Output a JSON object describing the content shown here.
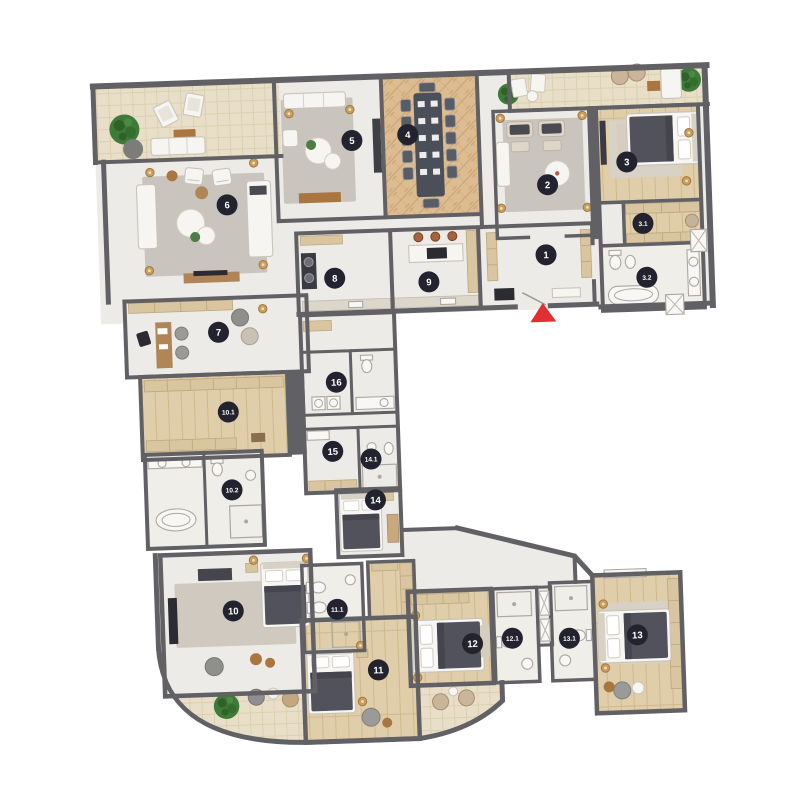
{
  "page": {
    "background": "#FFFFFF",
    "content": "apartment floor plan, C-shaped, top-down furnished view"
  },
  "plan": {
    "rotation_deg": -2,
    "entrance": {
      "marker": "red-arrow",
      "color": "#E03131"
    },
    "colors": {
      "wall": "#616165",
      "stone_floor": "#EDEBE7",
      "bath_floor": "#F0EEE9",
      "terrace_floor": "#E9DFC8",
      "wood_floor": "#E0CDA9",
      "herringbone_floor": "#DCBC90",
      "rug": "#C9C5BE",
      "badge_bg": "#23232F",
      "badge_text": "#FFFFFF",
      "tree_green": "#3E7B39",
      "gold_lamp": "#C99F5F",
      "copper_pendant": "#A5643E",
      "wood_furniture": "#AF8557",
      "wardrobe_tan": "#D9C6A0",
      "dark_furniture": "#3A3A42"
    },
    "rooms": [
      {
        "label": "1",
        "kind": "entrance-hall"
      },
      {
        "label": "2",
        "kind": "family-room"
      },
      {
        "label": "3",
        "kind": "bedroom"
      },
      {
        "label": "3.1",
        "kind": "walk-in-closet"
      },
      {
        "label": "3.2",
        "kind": "bathroom"
      },
      {
        "label": "4",
        "kind": "dining-room"
      },
      {
        "label": "5",
        "kind": "living-room"
      },
      {
        "label": "6",
        "kind": "living-room"
      },
      {
        "label": "7",
        "kind": "study"
      },
      {
        "label": "8",
        "kind": "laundry"
      },
      {
        "label": "9",
        "kind": "kitchen"
      },
      {
        "label": "10",
        "kind": "master-bedroom"
      },
      {
        "label": "10.1",
        "kind": "walk-in-closet"
      },
      {
        "label": "10.2",
        "kind": "bathroom"
      },
      {
        "label": "11",
        "kind": "bedroom"
      },
      {
        "label": "11.1",
        "kind": "bathroom"
      },
      {
        "label": "12",
        "kind": "bedroom"
      },
      {
        "label": "12.1",
        "kind": "bathroom"
      },
      {
        "label": "13",
        "kind": "bedroom"
      },
      {
        "label": "13.1",
        "kind": "bathroom"
      },
      {
        "label": "14",
        "kind": "bedroom"
      },
      {
        "label": "14.1",
        "kind": "bathroom"
      },
      {
        "label": "15",
        "kind": "dressing-room"
      },
      {
        "label": "16",
        "kind": "bathroom"
      }
    ]
  }
}
